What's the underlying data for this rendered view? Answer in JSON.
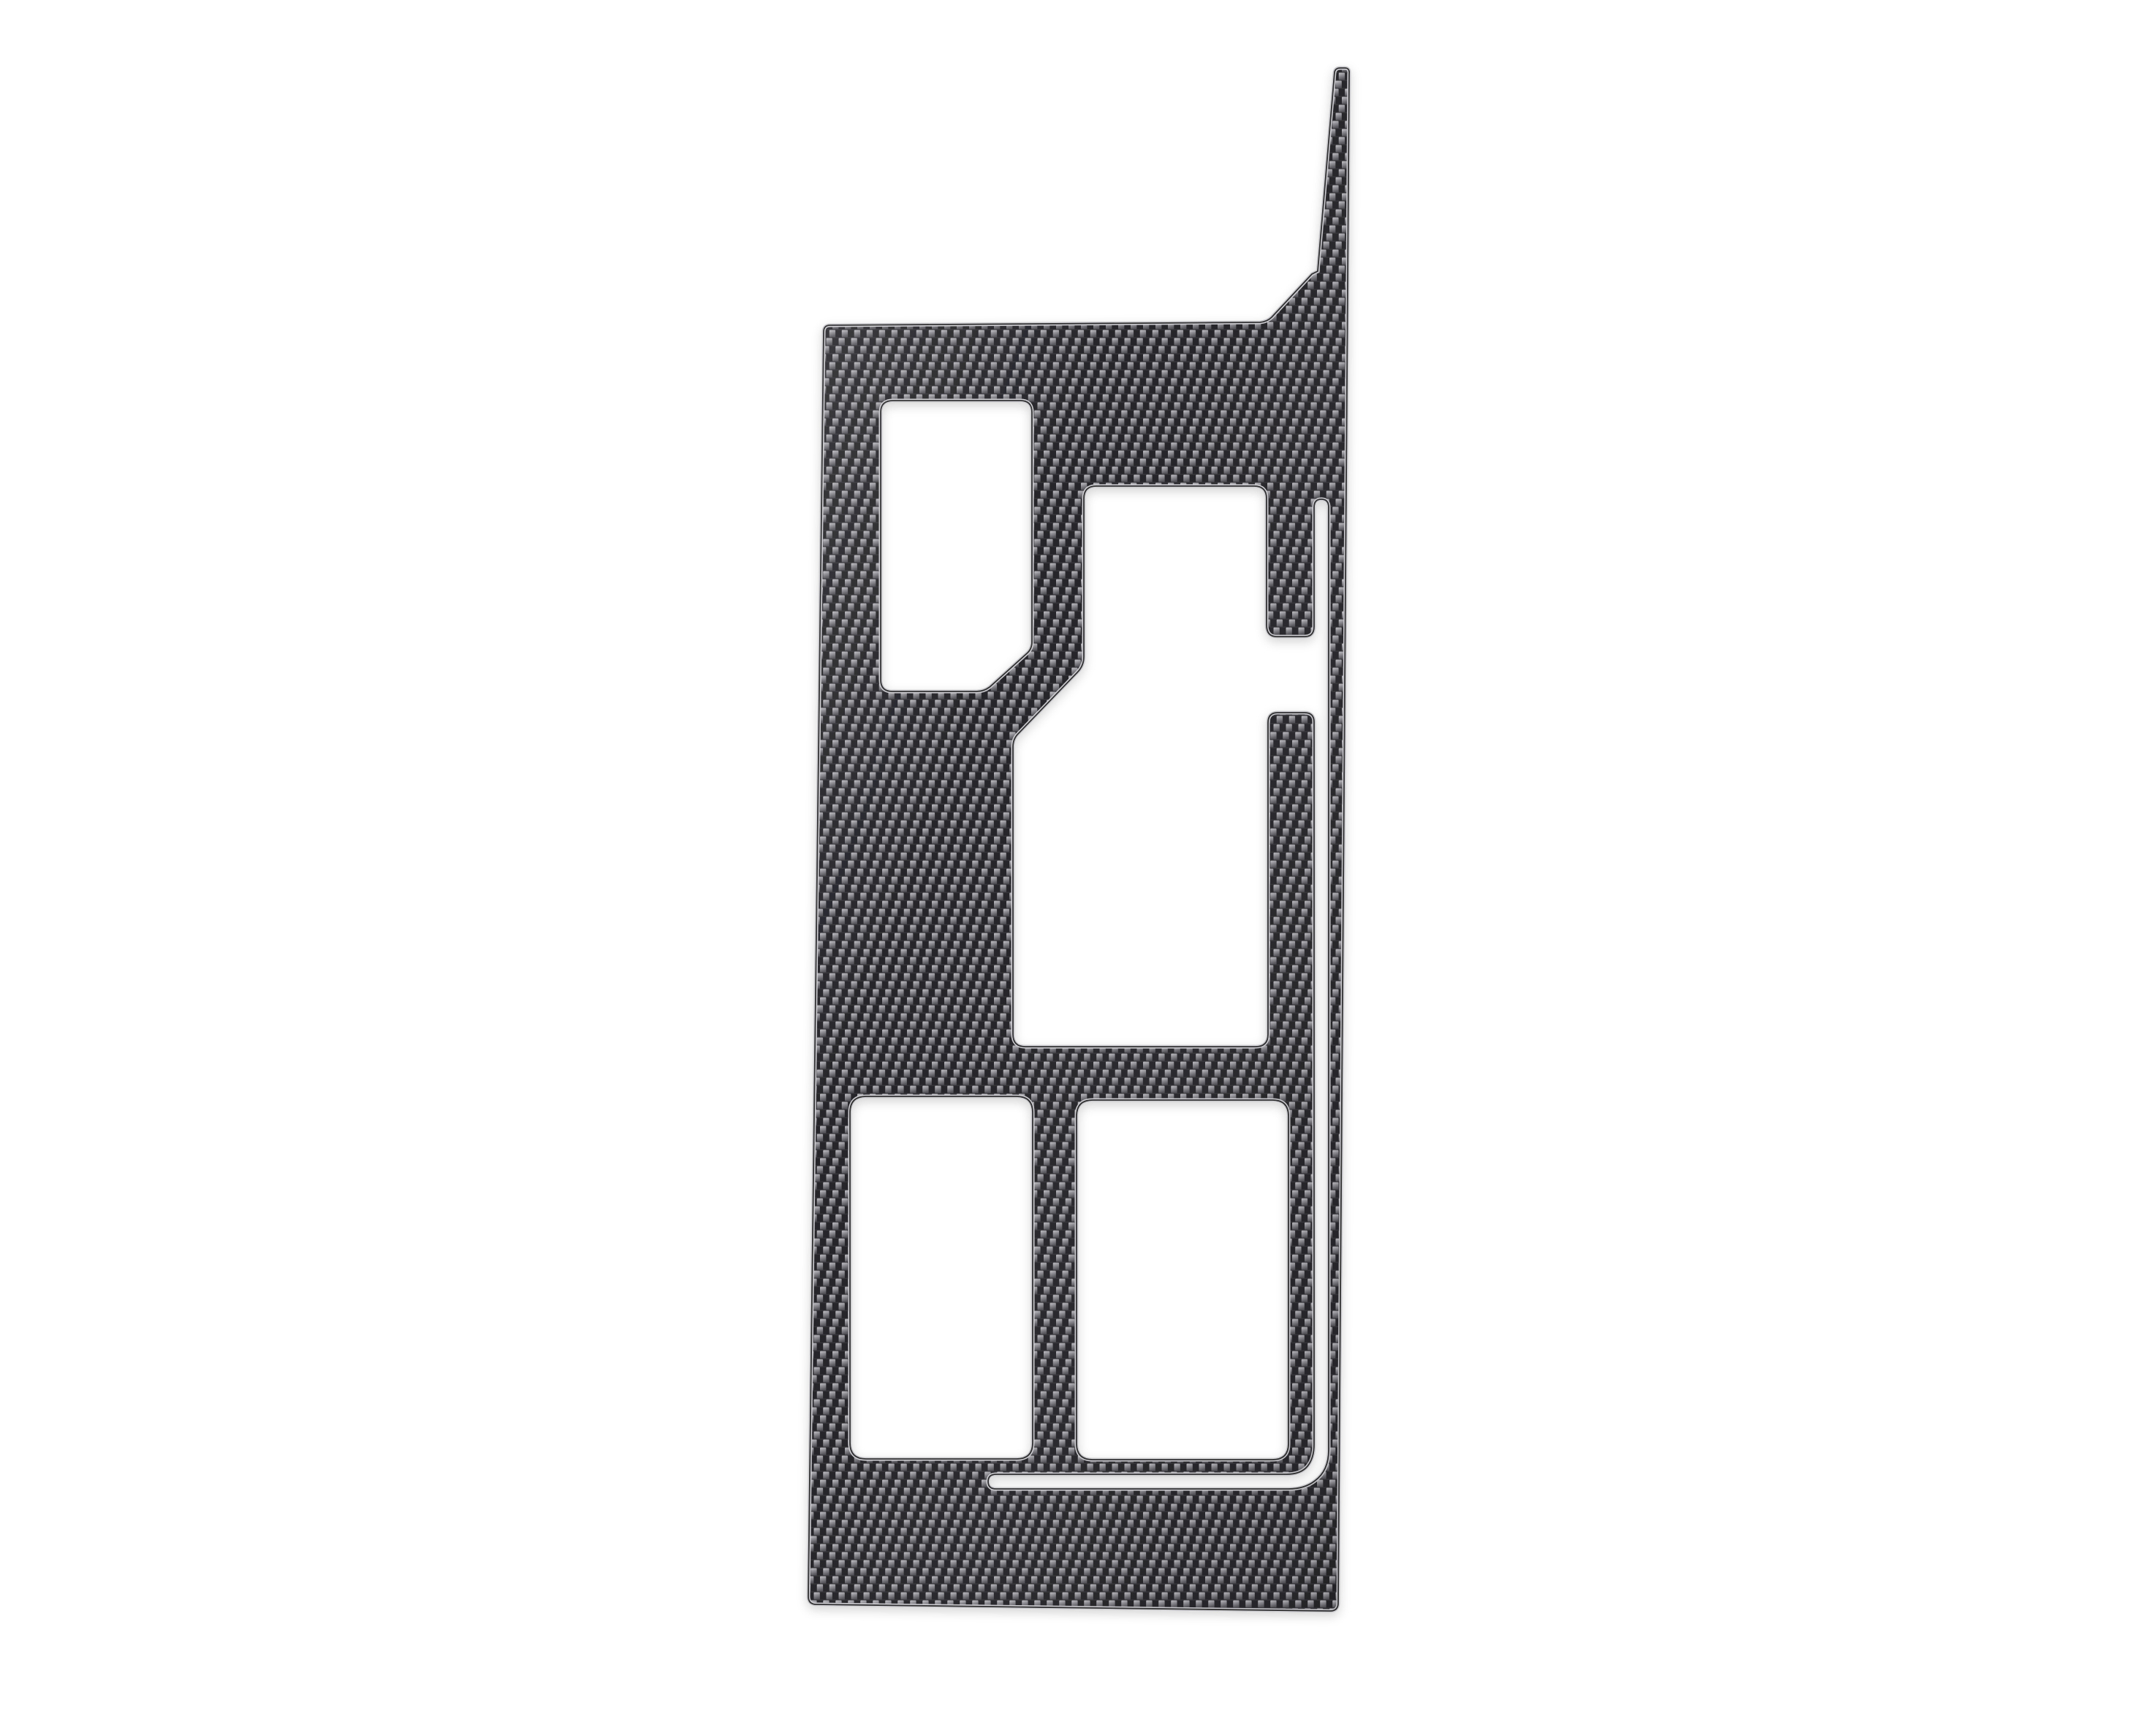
{
  "meta": {
    "title": "Carbon fiber center console gear shift panel trim overlay",
    "description": "Product photo of a die-cut glossy carbon fiber (2x2 twill weave) console trim sticker on a plain white background. The panel is a tall vertical plate with a thin tapered spike rising from its top right, a small rectangular cutout with a chamfered bottom-right corner at top left, a large irregular gear-shifter cutout in the middle connected to a thin L-shaped slot running down the right side and bending left near the bottom, and two large rounded rectangular window-switch cutouts at the bottom separated by a narrow divider."
  },
  "object": {
    "name": "carbon-fiber-console-trim-panel",
    "material": "carbon fiber 2x2 twill weave",
    "finish": "gloss",
    "background": "plain white",
    "cutouts": [
      "small rounded rectangle with chamfered bottom-right corner (top left)",
      "large gear-shifter opening with stepped left side and right-side notch bridge (middle)",
      "thin L-shaped slot: vertical run on right side bending into horizontal run near bottom",
      "large rounded rectangle window-switch opening (bottom left)",
      "large rounded rectangle window-switch opening (bottom right)"
    ],
    "features": [
      "tapered spike along top right edge",
      "narrow carbon divider strips between openings",
      "light beveled rim on all cut edges"
    ]
  },
  "colors": {
    "bg": "#ffffff",
    "weave-base": "#3a3a3f",
    "weave-dark": "#26262a",
    "weave-light-top": "#c6c6cb",
    "weave-light-bottom": "#55555b",
    "rim-light": "#cdcdd1",
    "outline-dark": "#141418"
  }
}
